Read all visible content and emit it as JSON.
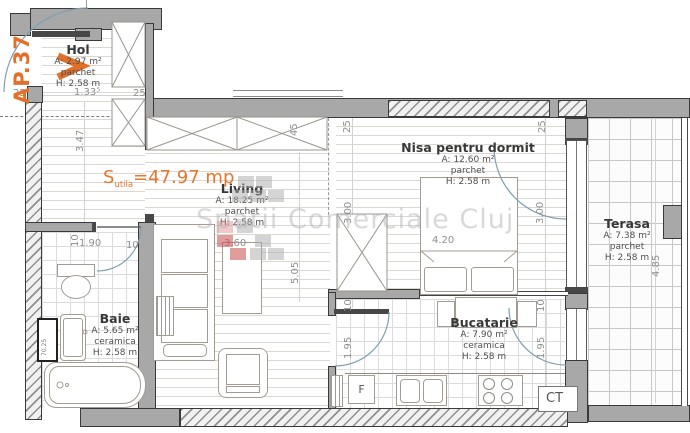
{
  "plan": {
    "apartment_label": "AP.37",
    "total_area": {
      "symbol": "S",
      "subscript": "utila",
      "value": "=47.97 mp"
    },
    "watermark": {
      "text": "Spatii Comerciale Cluj",
      "squares": [
        {
          "c": "gray",
          "x": 238,
          "y": 176
        },
        {
          "c": "gray",
          "x": 256,
          "y": 176
        },
        {
          "c": "gray",
          "x": 232,
          "y": 190
        },
        {
          "c": "gray",
          "x": 250,
          "y": 190
        },
        {
          "c": "gray",
          "x": 268,
          "y": 190
        },
        {
          "c": "lightred",
          "x": 217,
          "y": 221
        },
        {
          "c": "gray",
          "x": 237,
          "y": 221
        },
        {
          "c": "red",
          "x": 217,
          "y": 235
        },
        {
          "c": "gray",
          "x": 255,
          "y": 235
        },
        {
          "c": "red",
          "x": 230,
          "y": 248
        },
        {
          "c": "gray",
          "x": 250,
          "y": 248
        },
        {
          "c": "gray",
          "x": 268,
          "y": 248
        }
      ]
    },
    "rooms": [
      {
        "id": "hol",
        "name": "Hol",
        "area": "A: 2.97 m²",
        "floor": "parchet",
        "height": "H: 2.58 m"
      },
      {
        "id": "living",
        "name": "Living",
        "area": "A: 18.25 m²",
        "floor": "parchet",
        "height": "H: 2.58 m"
      },
      {
        "id": "nisa",
        "name": "Nisa pentru dormit",
        "area": "A: 12.60 m²",
        "floor": "parchet",
        "height": "H: 2.58 m"
      },
      {
        "id": "terasa",
        "name": "Terasa",
        "area": "A: 7.38 m²",
        "floor": "parchet",
        "height": "H: 2.58 m"
      },
      {
        "id": "baie",
        "name": "Baie",
        "area": "A: 5.65 m²",
        "floor": "ceramica",
        "height": "H: 2.58 m"
      },
      {
        "id": "bucatarie",
        "name": "Bucatarie",
        "area": "A: 7.90 m²",
        "floor": "ceramica",
        "height": "H: 2.58 m"
      }
    ],
    "labels": {
      "boiler": "CT",
      "fridge": "F",
      "shaft": "70.25"
    },
    "dimensions": [
      {
        "text": "25",
        "x": 13,
        "y": 89
      },
      {
        "text": "1.33⁵",
        "x": 74,
        "y": 88
      },
      {
        "text": "25",
        "x": 133,
        "y": 89
      },
      {
        "text": "3.47",
        "x": 76,
        "y": 152,
        "rot": 90
      },
      {
        "text": "45",
        "x": 290,
        "y": 136,
        "rot": 90
      },
      {
        "text": "25",
        "x": 343,
        "y": 133,
        "rot": 90
      },
      {
        "text": "25",
        "x": 538,
        "y": 133,
        "rot": 90
      },
      {
        "text": "3.00",
        "x": 344,
        "y": 224,
        "rot": 90
      },
      {
        "text": "3.00",
        "x": 536,
        "y": 224,
        "rot": 90
      },
      {
        "text": "4.20",
        "x": 432,
        "y": 236
      },
      {
        "text": "5.05",
        "x": 291,
        "y": 284,
        "rot": 90
      },
      {
        "text": "3.60",
        "x": 224,
        "y": 239
      },
      {
        "text": "10",
        "x": 71,
        "y": 247,
        "rot": 90
      },
      {
        "text": "1.90",
        "x": 79,
        "y": 239
      },
      {
        "text": "10",
        "x": 126,
        "y": 241
      },
      {
        "text": "10",
        "x": 344,
        "y": 312,
        "rot": 90
      },
      {
        "text": "1.95",
        "x": 344,
        "y": 359,
        "rot": 90
      },
      {
        "text": "10",
        "x": 537,
        "y": 312,
        "rot": 90
      },
      {
        "text": "1.95",
        "x": 537,
        "y": 359,
        "rot": 90
      },
      {
        "text": "4.85",
        "x": 652,
        "y": 277,
        "rot": 90
      }
    ],
    "colors": {
      "accent_orange": "#e2702a",
      "wall_gray": "#a8a8a8",
      "dimension_gray": "#8f8f8f",
      "door_arc_blue": "#7e9fb0",
      "watermark_gray": "#b4b4b4",
      "watermark_red": "#c84b4b"
    }
  }
}
